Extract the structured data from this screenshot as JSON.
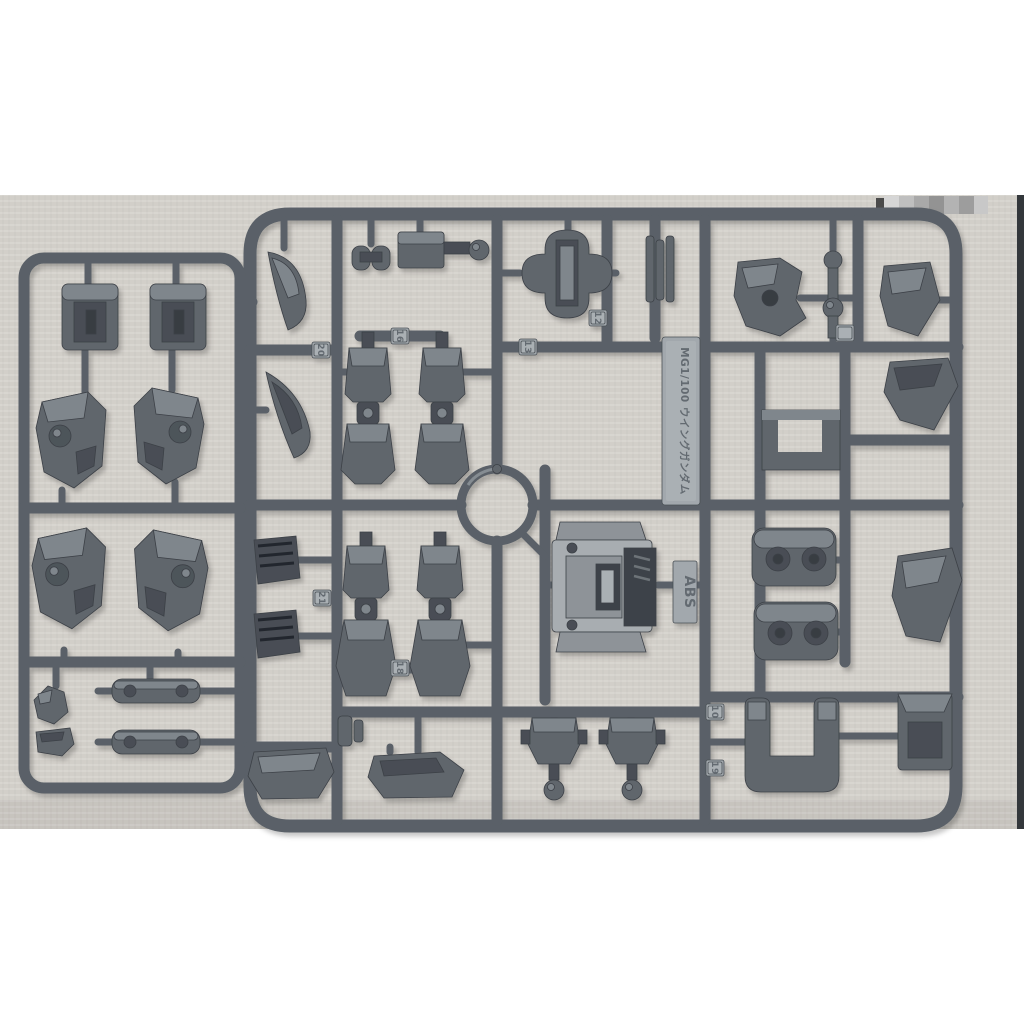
{
  "colors": {
    "background": "#ffffff",
    "fabric": "#d2cfc9",
    "plastic": "#5a6167",
    "plastic_dark": "#464c52",
    "plastic_light": "#82898f",
    "part_base": "#60666c",
    "tag_face": "#a2a8ad",
    "tag_text": "#646b71",
    "photo_edge": "#33373b"
  },
  "sprue": {
    "kit_tag": "MG1/100 ウイングガンダム",
    "material_tag": "ABS",
    "part_tags": [
      {
        "number": "20"
      },
      {
        "number": "16"
      },
      {
        "number": "12"
      },
      {
        "number": "13"
      },
      {
        "number": "21"
      },
      {
        "number": "18"
      },
      {
        "number": "10"
      },
      {
        "number": "19"
      }
    ]
  },
  "watermark": {
    "pixel_colors": [
      "#d6d6d6",
      "#bfbfbf",
      "#a9a9a9",
      "#939393",
      "#b3b3b3",
      "#9d9d9d",
      "#c8c8c8"
    ]
  }
}
